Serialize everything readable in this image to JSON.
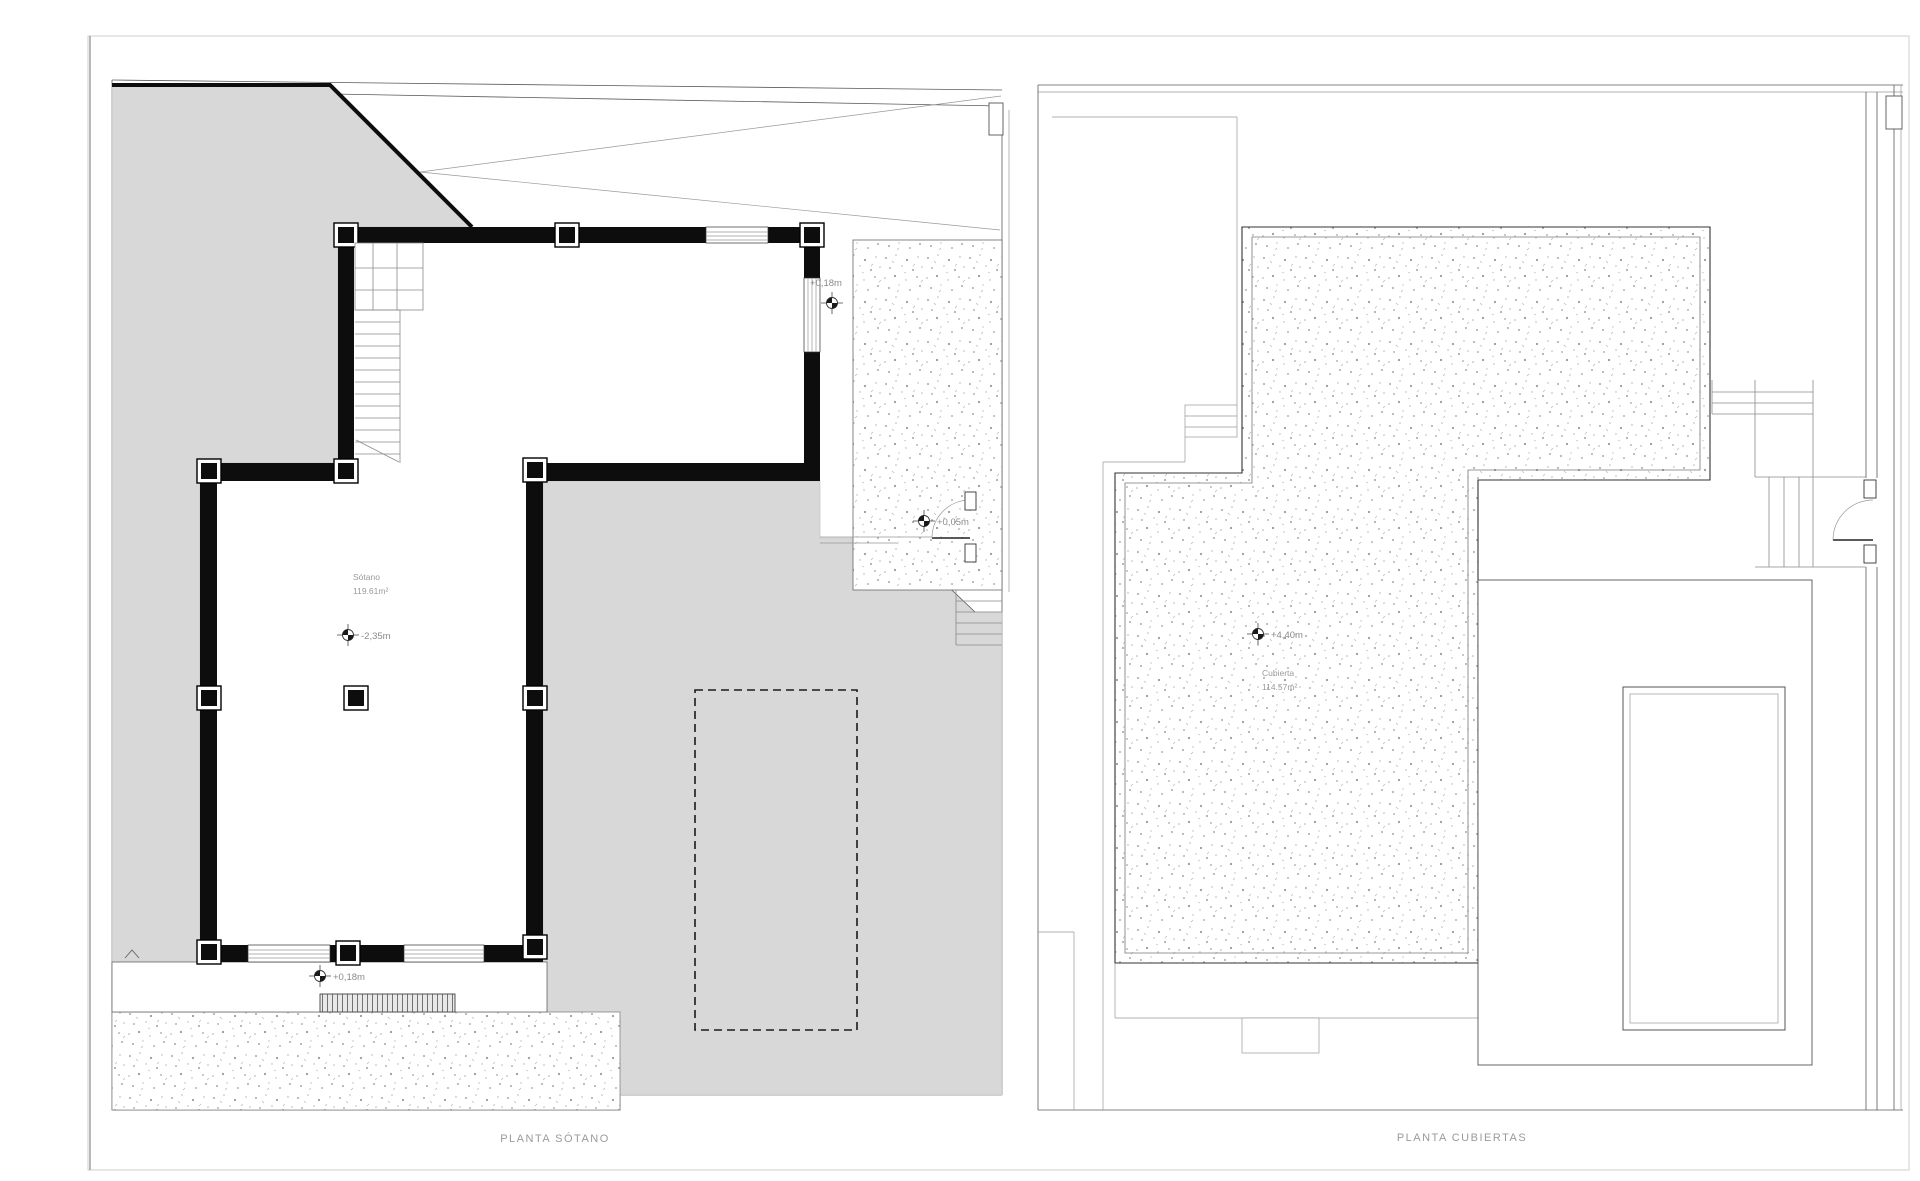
{
  "sheet": {
    "kind_note": "architectural plan sheet, two floor plans side by side",
    "colors": {
      "paper": "#ffffff",
      "terrain_fill": "#d8d8d8",
      "wall": "#0d0d0d",
      "thin_line": "#5a5a5a",
      "label_text": "#8a8a8a"
    }
  },
  "plans": {
    "sotano": {
      "title": "PLANTA SÓTANO",
      "room_label": {
        "name": "Sótano",
        "area": "119.61m²"
      },
      "levels": {
        "street": "+0,18m",
        "entry": "+0,05m",
        "basement": "-2,35m",
        "terrace": "+0,18m"
      },
      "icons": [
        "level-marker-icon"
      ]
    },
    "cubiertas": {
      "title": "PLANTA CUBIERTAS",
      "room_label": {
        "name": "Cubierta",
        "area": "114.57m²"
      },
      "levels": {
        "roof": "+4,40m"
      },
      "icons": [
        "level-marker-icon"
      ]
    }
  }
}
